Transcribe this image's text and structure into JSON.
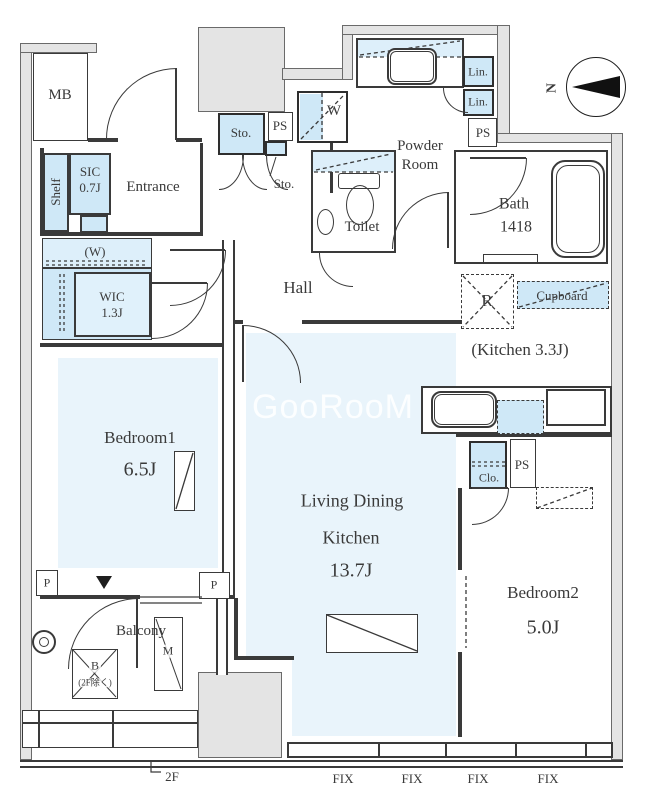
{
  "watermark": "GooRooM",
  "compass": {
    "north": "N"
  },
  "rooms": {
    "mb": "MB",
    "shelf": "Shelf",
    "sic": "SIC",
    "sic_size": "0.7J",
    "entrance": "Entrance",
    "sto_large": "Sto.",
    "ps_top": "PS",
    "sto_small": "Sto.",
    "washer": "W",
    "powder_line1": "Powder",
    "powder_line2": "Room",
    "lin_top": "Lin.",
    "lin_bottom": "Lin.",
    "ps_right": "PS",
    "bath": "Bath",
    "bath_size": "1418",
    "toilet": "Toilet",
    "hall": "Hall",
    "w_paren": "(W)",
    "wic": "WIC",
    "wic_size": "1.3J",
    "fridge": "R",
    "cupboard": "Cupboard",
    "kitchen": "(Kitchen 3.3J)",
    "bedroom1": "Bedroom1",
    "bedroom1_size": "6.5J",
    "ldk_line1": "Living Dining",
    "ldk_line2": "Kitchen",
    "ldk_size": "13.7J",
    "clo": "Clo.",
    "ps_bedroom2": "PS",
    "bedroom2": "Bedroom2",
    "bedroom2_size": "5.0J",
    "balcony": "Balcony",
    "balcony_b": "B",
    "balcony_b_note": "(2F除く)",
    "balcony_m": "M",
    "pipe_left": "P",
    "pipe_right": "P",
    "floor_mark": "2F"
  },
  "fix": [
    "FIX",
    "FIX",
    "FIX",
    "FIX"
  ],
  "colors": {
    "floor_blue": "#e9f4fb",
    "fixture_blue": "#cfe8f7",
    "wall_gray": "#e4e4e4",
    "line": "#3a3a3a"
  }
}
